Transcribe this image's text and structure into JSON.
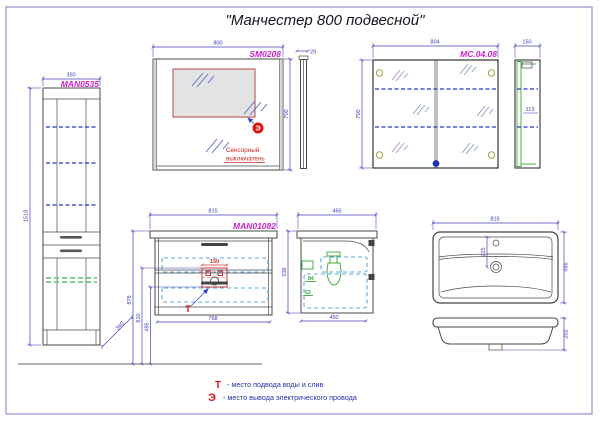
{
  "title": "\"Манчестер 800 подвесной\"",
  "colors": {
    "label_magenta": "#cc22cc",
    "dim_blue": "#4040bb",
    "marker_red": "#dd1111",
    "shelf_blue": "#2233cc",
    "drawer_dash_blue": "#58a8dc",
    "green": "#3aa83a",
    "border_blue": "#9090d0"
  },
  "tall_cabinet": {
    "label": "MAN0535",
    "width": "350",
    "height": "1518",
    "depth": "340"
  },
  "mirror": {
    "label": "SM0208",
    "width": "800",
    "height": "700",
    "thickness": "29",
    "marker": "Э",
    "note1": "Сенсорный",
    "note2": "выключатель"
  },
  "mirror_cabinet": {
    "label": "MC.04.08",
    "width": "804",
    "height": "700",
    "depth": "150",
    "shelf_depth": "113"
  },
  "vanity": {
    "label": "MAN01082",
    "width": "815",
    "inner_width": "768",
    "cutout_width": "150",
    "height_top": "878",
    "height_supply": "610",
    "height_drain": "495",
    "marker": "Т"
  },
  "vanity_side": {
    "depth": "465",
    "height": "536",
    "bottom_depth": "450",
    "dim_a": "84",
    "dim_b": "53"
  },
  "sink": {
    "width": "815",
    "depth": "465",
    "drain_offset": "215",
    "height": "202"
  },
  "legend": {
    "t_sym": "Т",
    "t_text": "- место подвода воды и слив",
    "e_sym": "Э",
    "e_text": "- место вывода электрического провода"
  }
}
